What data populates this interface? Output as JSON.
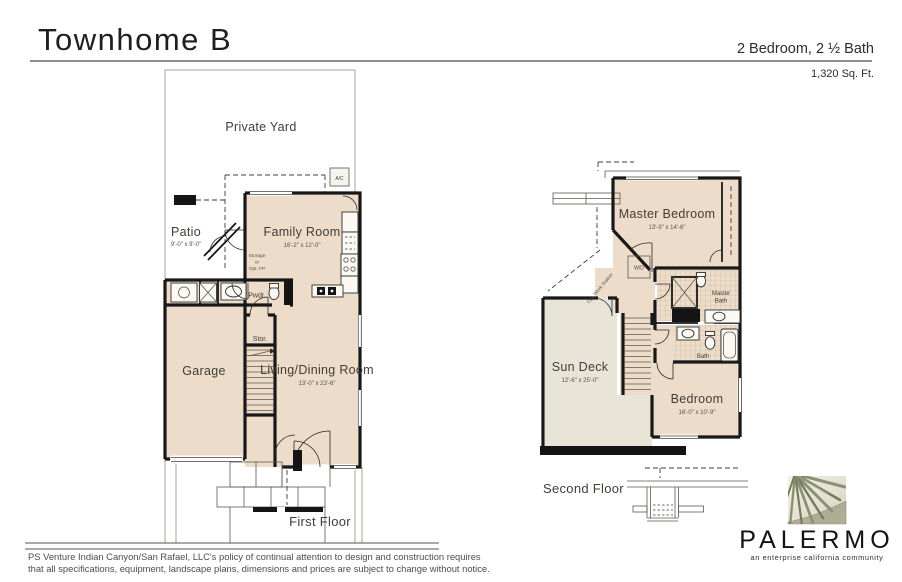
{
  "header": {
    "title": "Townhome B",
    "spec": "2 Bedroom, 2 ½ Bath",
    "sqft": "1,320 Sq. Ft."
  },
  "first_floor": {
    "caption": "First Floor",
    "yard": "Private Yard",
    "ac": "A/C",
    "patio": {
      "name": "Patio",
      "dims": "9'-0\" x 9'-0\""
    },
    "family_room": {
      "name": "Family Room",
      "dims": "16'-2\" x 12'-0\""
    },
    "storage": {
      "l1": "Storage",
      "l2": "or",
      "l3": "Opt. FP"
    },
    "powder": "Pwdr.",
    "garage": "Garage",
    "stor": "Stor.",
    "living_dining": {
      "name": "Living/Dining Room",
      "dims": "13'-0\" x 23'-6\""
    }
  },
  "second_floor": {
    "caption": "Second Floor",
    "master_bedroom": {
      "name": "Master Bedroom",
      "dims": "13'-9\" x 14'-6\""
    },
    "wd": "W/D",
    "opt_work_station": "Opt. Work Station",
    "master_bath": {
      "l1": "Master",
      "l2": "Bath"
    },
    "bath": "Bath",
    "sun_deck": {
      "name": "Sun Deck",
      "dims": "12'-6\" x 25'-0\""
    },
    "bedroom": {
      "name": "Bedroom",
      "dims": "16'-0\" x 10'-9\""
    }
  },
  "footer": {
    "disclaimer_line1": "PS Venture Indian Canyon/San Rafael, LLC's policy of continual attention to design and construction requires",
    "disclaimer_line2": "that all specifications, equipment, landscape plans, dimensions and prices are subject to change without notice.",
    "logo": {
      "wordmark": "PALERMO",
      "tagline": "an enterprise california community"
    }
  },
  "colors": {
    "floor": "#ecdcc9",
    "yard": "#e8e5d8",
    "wall": "#181818",
    "logo_green": "#8b9172"
  }
}
